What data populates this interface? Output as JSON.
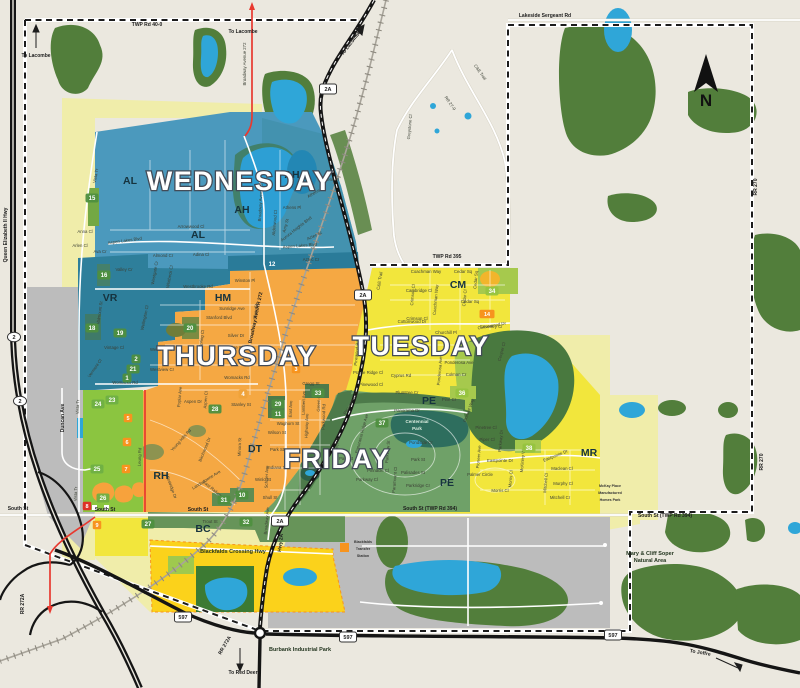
{
  "map": {
    "compass": "N",
    "colors": {
      "background": "#ebe8df",
      "forest": "#527e3b",
      "water": "#2fa6d8",
      "wednesday": "#4b99bd",
      "thursday": "#f5a843",
      "tuesday": "#f2e63c",
      "friday": "#6fa168",
      "pale_yellow": "#f0edaa",
      "gold": "#fbd21b",
      "gray_area": "#bcbcbc",
      "highway": "#151515",
      "red_route": "#e8392f"
    },
    "zones": [
      {
        "name": "WEDNESDAY",
        "color": "#4b99bd",
        "x": 240,
        "y": 181
      },
      {
        "name": "THURSDAY",
        "color": "#f5a843",
        "x": 237,
        "y": 356
      },
      {
        "name": "TUESDAY",
        "color": "#f2e63c",
        "x": 421,
        "y": 346
      },
      {
        "name": "FRIDAY",
        "color": "#6fa168",
        "x": 337,
        "y": 459
      }
    ],
    "area_codes": [
      {
        "t": "AL",
        "x": 130,
        "y": 184
      },
      {
        "t": "AL",
        "x": 198,
        "y": 238
      },
      {
        "t": "AH",
        "x": 292,
        "y": 178
      },
      {
        "t": "AH",
        "x": 242,
        "y": 213
      },
      {
        "t": "VR",
        "x": 110,
        "y": 301
      },
      {
        "t": "HM",
        "x": 223,
        "y": 301
      },
      {
        "t": "RH",
        "x": 161,
        "y": 479
      },
      {
        "t": "CM",
        "x": 458,
        "y": 288
      },
      {
        "t": "DT",
        "x": 255,
        "y": 452
      },
      {
        "t": "PE",
        "x": 429,
        "y": 404
      },
      {
        "t": "PE",
        "x": 447,
        "y": 486
      },
      {
        "t": "MR",
        "x": 589,
        "y": 456
      },
      {
        "t": "BC",
        "x": 203,
        "y": 532
      }
    ],
    "park_badges": [
      {
        "n": "15",
        "x": 92,
        "y": 198
      },
      {
        "n": "16",
        "x": 104,
        "y": 275
      },
      {
        "n": "18",
        "x": 92,
        "y": 328
      },
      {
        "n": "19",
        "x": 120,
        "y": 333
      },
      {
        "n": "20",
        "x": 190,
        "y": 328
      },
      {
        "n": "2",
        "x": 136,
        "y": 359
      },
      {
        "n": "21",
        "x": 133,
        "y": 369
      },
      {
        "n": "1",
        "x": 127,
        "y": 378
      },
      {
        "n": "12",
        "x": 272,
        "y": 264,
        "bg": "#2a7b99"
      },
      {
        "n": "4",
        "x": 243,
        "y": 394,
        "bg": "#efa23a"
      },
      {
        "n": "28",
        "x": 215,
        "y": 409
      },
      {
        "n": "29",
        "x": 278,
        "y": 404
      },
      {
        "n": "11",
        "x": 278,
        "y": 414
      },
      {
        "n": "33",
        "x": 318,
        "y": 393
      },
      {
        "n": "37",
        "x": 382,
        "y": 423
      },
      {
        "n": "34",
        "x": 492,
        "y": 291,
        "bg": "#96c43f"
      },
      {
        "n": "36",
        "x": 462,
        "y": 393,
        "bg": "#96c43f"
      },
      {
        "n": "38",
        "x": 529,
        "y": 448,
        "bg": "#96c43f"
      },
      {
        "n": "10",
        "x": 242,
        "y": 495
      },
      {
        "n": "31",
        "x": 224,
        "y": 500
      },
      {
        "n": "32",
        "x": 246,
        "y": 522
      },
      {
        "n": "27",
        "x": 148,
        "y": 524
      },
      {
        "n": "23",
        "x": 112,
        "y": 400,
        "bg": "#6fb043"
      },
      {
        "n": "24",
        "x": 98,
        "y": 404,
        "bg": "#6fb043"
      },
      {
        "n": "25",
        "x": 97,
        "y": 469,
        "bg": "#6fb043"
      },
      {
        "n": "26",
        "x": 103,
        "y": 498,
        "bg": "#6fb043"
      }
    ],
    "facility_badges": [
      {
        "n": "5",
        "x": 128,
        "y": 418
      },
      {
        "n": "6",
        "x": 127,
        "y": 442
      },
      {
        "n": "7",
        "x": 126,
        "y": 469
      },
      {
        "n": "8",
        "x": 87,
        "y": 506,
        "bg": "#dd3327"
      },
      {
        "n": "9",
        "x": 97,
        "y": 525
      },
      {
        "n": "3",
        "x": 296,
        "y": 369
      },
      {
        "n": "14",
        "x": 487,
        "y": 314,
        "w": 15
      }
    ],
    "shields": [
      {
        "t": "2A",
        "x": 328,
        "y": 89,
        "type": "rect"
      },
      {
        "t": "2A",
        "x": 363,
        "y": 295,
        "type": "rect"
      },
      {
        "t": "2A",
        "x": 280,
        "y": 521,
        "type": "rect"
      },
      {
        "t": "597",
        "x": 183,
        "y": 617,
        "type": "rect"
      },
      {
        "t": "597",
        "x": 348,
        "y": 637,
        "type": "rect"
      },
      {
        "t": "597",
        "x": 613,
        "y": 635,
        "type": "rect"
      },
      {
        "t": "2",
        "x": 14,
        "y": 337,
        "type": "oval"
      },
      {
        "t": "2",
        "x": 20,
        "y": 401,
        "type": "oval"
      }
    ],
    "road_labels": [
      {
        "t": "TWP Rd 40-0",
        "x": 147,
        "y": 26
      },
      {
        "t": "Lakeside Sergeant Rd",
        "x": 545,
        "y": 17
      },
      {
        "t": "TWP Rd 395",
        "x": 447,
        "y": 258
      },
      {
        "t": "South St (TWP Rd 394)",
        "x": 430,
        "y": 510
      },
      {
        "t": "South St (TWP Rd 394)",
        "x": 665,
        "y": 517
      },
      {
        "t": "South St",
        "x": 18,
        "y": 510
      },
      {
        "t": "South St",
        "x": 105,
        "y": 511
      },
      {
        "t": "South St",
        "x": 198,
        "y": 511
      },
      {
        "t": "RR 270",
        "x": 757,
        "y": 187,
        "r": -90
      },
      {
        "t": "RR 270",
        "x": 763,
        "y": 462,
        "r": -90
      },
      {
        "t": "RR 272A",
        "x": 24,
        "y": 604,
        "r": -90
      },
      {
        "t": "RR 272A",
        "x": 226,
        "y": 646,
        "r": -60
      },
      {
        "t": "Hwy 2A",
        "x": 282,
        "y": 543,
        "r": -83
      },
      {
        "t": "Broadway Ave/RR 272",
        "x": 257,
        "y": 318,
        "r": -78
      },
      {
        "t": "Queen Elizabeth II Hwy",
        "x": 7,
        "y": 235,
        "r": -90
      },
      {
        "t": "Duncan Ave",
        "x": 64,
        "y": 418,
        "r": -90
      }
    ],
    "directions": [
      {
        "t": "To Lacombe",
        "x": 36,
        "y": 57
      },
      {
        "t": "To Lacombe",
        "x": 243,
        "y": 33
      },
      {
        "t": "To Lacombe",
        "x": 352,
        "y": 44,
        "r": -52
      },
      {
        "t": "To Red Deer",
        "x": 243,
        "y": 674
      },
      {
        "t": "To Joffre",
        "x": 700,
        "y": 654,
        "r": 10
      }
    ],
    "places": [
      {
        "lines": [
          "Burbank Industrial Park"
        ],
        "x": 300,
        "y": 651,
        "cls": "place"
      },
      {
        "lines": [
          "Blackfalds Crossing Hwy"
        ],
        "x": 233,
        "y": 553,
        "cls": "place"
      },
      {
        "lines": [
          "Mary & Cliff Soper",
          "Natural Area"
        ],
        "x": 650,
        "y": 555,
        "cls": "place"
      },
      {
        "lines": [
          "Centennial",
          "Park"
        ],
        "x": 417,
        "y": 423,
        "cls": "place-light"
      },
      {
        "lines": [
          "Blackfalds",
          "Transfer",
          "Station"
        ],
        "x": 363,
        "y": 543,
        "cls": "place-tiny"
      },
      {
        "lines": [
          "McKay Place",
          "Manufactured",
          "Homes Park"
        ],
        "x": 610,
        "y": 487,
        "cls": "place-tiny"
      }
    ],
    "streets": [
      {
        "t": "Vista Tr",
        "x": 97,
        "y": 176,
        "r": -80
      },
      {
        "t": "Anna Cl",
        "x": 85,
        "y": 233
      },
      {
        "t": "Arlen Cl",
        "x": 80,
        "y": 247
      },
      {
        "t": "Ava Cr",
        "x": 100,
        "y": 253
      },
      {
        "t": "Aspen Lakes Blvd",
        "x": 125,
        "y": 242,
        "r": -8
      },
      {
        "t": "Arrowwood Cl",
        "x": 191,
        "y": 228
      },
      {
        "t": "Almond Cr",
        "x": 163,
        "y": 257
      },
      {
        "t": "Adina Cl",
        "x": 201,
        "y": 256
      },
      {
        "t": "Aspen Lakes Blvd",
        "x": 300,
        "y": 247,
        "r": -5
      },
      {
        "t": "Athens Pl",
        "x": 330,
        "y": 181
      },
      {
        "t": "Athens Rd",
        "x": 317,
        "y": 193,
        "r": -30
      },
      {
        "t": "Athens Pl",
        "x": 292,
        "y": 209
      },
      {
        "t": "Amy St",
        "x": 287,
        "y": 226,
        "r": -75
      },
      {
        "t": "Aztec St",
        "x": 315,
        "y": 237,
        "r": -25
      },
      {
        "t": "Aztec Cr",
        "x": 311,
        "y": 261
      },
      {
        "t": "Aurora Heights Blvd",
        "x": 297,
        "y": 230,
        "r": -38
      },
      {
        "t": "Alderwood Cl",
        "x": 276,
        "y": 223,
        "r": -85
      },
      {
        "t": "Broadway Avenue 272",
        "x": 246,
        "y": 64,
        "r": -90
      },
      {
        "t": "Broadway Avenue 272",
        "x": 262,
        "y": 200,
        "r": -87
      },
      {
        "t": "Valley Cr",
        "x": 124,
        "y": 271
      },
      {
        "t": "Westgate Cr",
        "x": 156,
        "y": 273,
        "r": -80
      },
      {
        "t": "Whitbeck Cl",
        "x": 171,
        "y": 277,
        "r": -80
      },
      {
        "t": "Winston Pl",
        "x": 245,
        "y": 282
      },
      {
        "t": "Westbrooke Rd",
        "x": 198,
        "y": 288
      },
      {
        "t": "Vista Tr",
        "x": 79,
        "y": 407,
        "r": -88
      },
      {
        "t": "Vista Tr",
        "x": 77,
        "y": 494,
        "r": -88
      },
      {
        "t": "Valmount St",
        "x": 101,
        "y": 313,
        "r": -82
      },
      {
        "t": "Vintage Cl",
        "x": 114,
        "y": 349
      },
      {
        "t": "Vermont Cl",
        "x": 96,
        "y": 369,
        "r": -55
      },
      {
        "t": "Wellington Cl",
        "x": 146,
        "y": 318,
        "r": -78
      },
      {
        "t": "Womacks Rd",
        "x": 125,
        "y": 384
      },
      {
        "t": "Womacks Rd",
        "x": 237,
        "y": 379
      },
      {
        "t": "Sunridge Ave",
        "x": 232,
        "y": 310
      },
      {
        "t": "Stanford Blvd",
        "x": 219,
        "y": 319
      },
      {
        "t": "Silver Dr",
        "x": 236,
        "y": 337
      },
      {
        "t": "Silver St",
        "x": 257,
        "y": 312,
        "r": -85
      },
      {
        "t": "Sunrise Cl",
        "x": 233,
        "y": 349
      },
      {
        "t": "Spring Cl",
        "x": 203,
        "y": 339,
        "r": -82
      },
      {
        "t": "Westview Cr",
        "x": 162,
        "y": 351
      },
      {
        "t": "Westview Cr",
        "x": 162,
        "y": 371
      },
      {
        "t": "Gregg St",
        "x": 311,
        "y": 385
      },
      {
        "t": "Stanley St",
        "x": 241,
        "y": 406
      },
      {
        "t": "Aspen Dr",
        "x": 193,
        "y": 403
      },
      {
        "t": "Poplar Ave",
        "x": 181,
        "y": 397,
        "r": -85
      },
      {
        "t": "Aspen Cl",
        "x": 207,
        "y": 400,
        "r": -85
      },
      {
        "t": "Young Hills Rd",
        "x": 182,
        "y": 441,
        "r": -48
      },
      {
        "t": "Birchwood Dr",
        "x": 206,
        "y": 450,
        "r": -68
      },
      {
        "t": "Landsdowne Ave",
        "x": 207,
        "y": 481,
        "r": -32
      },
      {
        "t": "Westridge Dr",
        "x": 170,
        "y": 487,
        "r": 70
      },
      {
        "t": "Leung Rd",
        "x": 141,
        "y": 457,
        "r": -88
      },
      {
        "t": "East Railway St",
        "x": 214,
        "y": 492,
        "r": 40
      },
      {
        "t": "East Ave",
        "x": 292,
        "y": 409,
        "r": -88
      },
      {
        "t": "Lambert Ave",
        "x": 305,
        "y": 403,
        "r": -88
      },
      {
        "t": "Green Cl",
        "x": 320,
        "y": 403,
        "r": -88
      },
      {
        "t": "Highway Ave",
        "x": 308,
        "y": 426,
        "r": -88
      },
      {
        "t": "Waghorn St",
        "x": 288,
        "y": 425
      },
      {
        "t": "Wilson St",
        "x": 277,
        "y": 434
      },
      {
        "t": "Park St",
        "x": 277,
        "y": 451
      },
      {
        "t": "Indiana St",
        "x": 277,
        "y": 469
      },
      {
        "t": "Winlo St",
        "x": 263,
        "y": 481
      },
      {
        "t": "Shull St",
        "x": 270,
        "y": 499
      },
      {
        "t": "Minora St",
        "x": 241,
        "y": 447,
        "r": -88
      },
      {
        "t": "Schuler Ave",
        "x": 268,
        "y": 477,
        "r": -88
      },
      {
        "t": "Broadway Ave",
        "x": 268,
        "y": 521,
        "r": -85
      },
      {
        "t": "Trout St",
        "x": 210,
        "y": 523
      },
      {
        "t": "Panorama Dr",
        "x": 407,
        "y": 412
      },
      {
        "t": "Parkwood Rd",
        "x": 325,
        "y": 417,
        "r": -88
      },
      {
        "t": "Panorama Cl",
        "x": 352,
        "y": 404,
        "r": -60
      },
      {
        "t": "Panorama Ridge Ave",
        "x": 363,
        "y": 434,
        "r": -75
      },
      {
        "t": "Prospect St",
        "x": 338,
        "y": 449,
        "r": -85
      },
      {
        "t": "Park St",
        "x": 346,
        "y": 460
      },
      {
        "t": "Pondside Cr",
        "x": 421,
        "y": 444
      },
      {
        "t": "Park St",
        "x": 418,
        "y": 461
      },
      {
        "t": "Palisades St",
        "x": 413,
        "y": 474
      },
      {
        "t": "Parkridge Cr",
        "x": 418,
        "y": 487
      },
      {
        "t": "Pinnacle Cl",
        "x": 378,
        "y": 472
      },
      {
        "t": "Parkway Cl",
        "x": 367,
        "y": 481
      },
      {
        "t": "Paramount Cl",
        "x": 396,
        "y": 480,
        "r": -85
      },
      {
        "t": "Parkview St",
        "x": 389,
        "y": 452,
        "r": -85
      },
      {
        "t": "Plumtree Cr",
        "x": 407,
        "y": 394
      },
      {
        "t": "Pinetree Cl",
        "x": 486,
        "y": 429
      },
      {
        "t": "Coachman Way",
        "x": 426,
        "y": 273
      },
      {
        "t": "Cedar Sq",
        "x": 463,
        "y": 273
      },
      {
        "t": "Cedar Sq",
        "x": 470,
        "y": 303
      },
      {
        "t": "Cedar Sq",
        "x": 477,
        "y": 280,
        "r": -85
      },
      {
        "t": "Cedar Cl",
        "x": 466,
        "y": 298,
        "r": -85
      },
      {
        "t": "Cambridge Cl",
        "x": 419,
        "y": 292
      },
      {
        "t": "Crimson Cl",
        "x": 414,
        "y": 295,
        "r": -85
      },
      {
        "t": "Crimson Cl",
        "x": 417,
        "y": 320
      },
      {
        "t": "Coachman Way",
        "x": 437,
        "y": 300,
        "r": -85
      },
      {
        "t": "Cottonwood Dr",
        "x": 412,
        "y": 323
      },
      {
        "t": "Cottonwood Dr",
        "x": 492,
        "y": 327,
        "r": -10
      },
      {
        "t": "Churchill Pl",
        "x": 446,
        "y": 334
      },
      {
        "t": "Coventry Cl",
        "x": 491,
        "y": 328
      },
      {
        "t": "Cooper Cl",
        "x": 503,
        "y": 352,
        "r": -75
      },
      {
        "t": "Ponderosa Ave",
        "x": 459,
        "y": 364
      },
      {
        "t": "Ponderosa Ave",
        "x": 441,
        "y": 371,
        "r": -85
      },
      {
        "t": "Cyprus Rd",
        "x": 401,
        "y": 377
      },
      {
        "t": "Colman Cr",
        "x": 456,
        "y": 376
      },
      {
        "t": "Pine Cr",
        "x": 449,
        "y": 401
      },
      {
        "t": "Pioneer Way",
        "x": 470,
        "y": 411,
        "r": -70
      },
      {
        "t": "Piper Cl",
        "x": 487,
        "y": 441
      },
      {
        "t": "Parkway Dr",
        "x": 502,
        "y": 441,
        "r": -85
      },
      {
        "t": "Pioneer Ave",
        "x": 480,
        "y": 457,
        "r": -85
      },
      {
        "t": "Eastpointe Dr",
        "x": 500,
        "y": 462
      },
      {
        "t": "Eastpointe Dr",
        "x": 556,
        "y": 457,
        "r": -22
      },
      {
        "t": "Palmer Circle",
        "x": 480,
        "y": 476
      },
      {
        "t": "Morris Cl",
        "x": 512,
        "y": 479,
        "r": -85
      },
      {
        "t": "Morris Cl",
        "x": 500,
        "y": 492
      },
      {
        "t": "McKinley Way",
        "x": 524,
        "y": 459,
        "r": -85
      },
      {
        "t": "Maclean Cl",
        "x": 562,
        "y": 470
      },
      {
        "t": "Murphy Cl",
        "x": 563,
        "y": 485
      },
      {
        "t": "Mitchell Cr",
        "x": 560,
        "y": 499
      },
      {
        "t": "Mitchell Cl",
        "x": 547,
        "y": 483,
        "r": -85
      },
      {
        "t": "Prairie Ridge Cl",
        "x": 368,
        "y": 374
      },
      {
        "t": "Pinewood Rd",
        "x": 358,
        "y": 353,
        "r": -85
      },
      {
        "t": "Pinewood Cl",
        "x": 371,
        "y": 386
      },
      {
        "t": "Greystone Cl",
        "x": 411,
        "y": 127,
        "r": -85
      },
      {
        "t": "C&E Trail",
        "x": 479,
        "y": 73,
        "r": 55
      },
      {
        "t": "C&E Trail",
        "x": 381,
        "y": 281,
        "r": -80
      },
      {
        "t": "RR 27-0",
        "x": 449,
        "y": 104,
        "r": 55
      }
    ]
  }
}
